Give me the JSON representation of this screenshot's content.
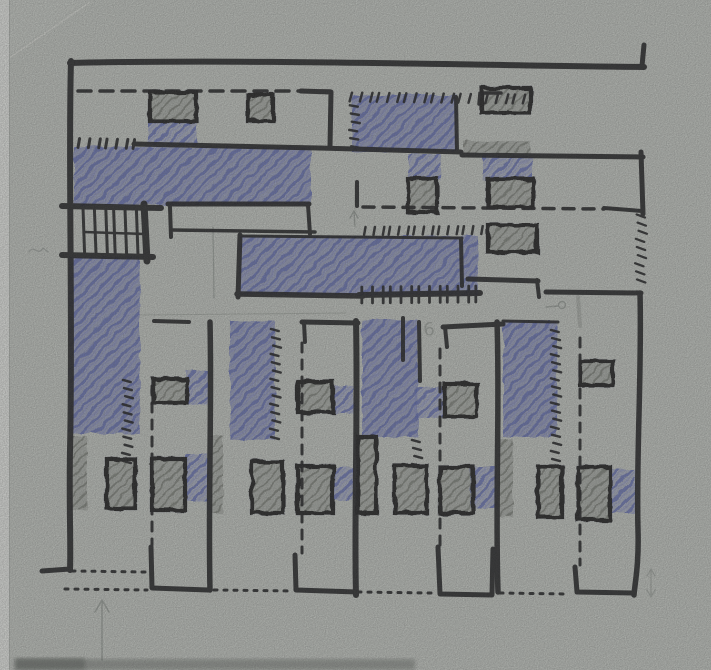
{
  "meta": {
    "title": "Hand-drawn architectural plan sketch",
    "media": "black marker, blue crayon and gray pencil on gray sketch paper"
  },
  "canvas": {
    "width": 711,
    "height": 670
  },
  "colors": {
    "paper": "#c6cac4",
    "paper_light": "#ced2cc",
    "crease": "#daddd7",
    "edge_strip": "#e9ebe7",
    "edge_line": "#aaaea9",
    "shadow": "#5c605b",
    "ink": "#1c1c1e",
    "blue": "#5e69b3",
    "blue_light": "#8b93c9",
    "blue_bg": "rgba(104,113,184,0.30)",
    "blue_dense": "rgba(92,102,175,0.22)",
    "gray": "#70746c",
    "gray_bg": "rgba(128,132,125,0.38)",
    "pencil": "#878d88"
  },
  "drawing": {
    "blue_areas": [
      {
        "x": 148,
        "y": 122,
        "w": 49,
        "h": 23,
        "dense": false
      },
      {
        "x": 74,
        "y": 147,
        "w": 237,
        "h": 58,
        "dense": true
      },
      {
        "x": 69,
        "y": 257,
        "w": 71,
        "h": 177,
        "dense": true
      },
      {
        "x": 352,
        "y": 95,
        "w": 105,
        "h": 57,
        "dense": true
      },
      {
        "x": 408,
        "y": 154,
        "w": 33,
        "h": 27,
        "dense": false
      },
      {
        "x": 483,
        "y": 155,
        "w": 49,
        "h": 26,
        "dense": false
      },
      {
        "x": 240,
        "y": 236,
        "w": 238,
        "h": 59,
        "dense": true
      },
      {
        "x": 230,
        "y": 321,
        "w": 45,
        "h": 119,
        "dense": true
      },
      {
        "x": 362,
        "y": 320,
        "w": 56,
        "h": 117,
        "dense": true
      },
      {
        "x": 503,
        "y": 321,
        "w": 54,
        "h": 116,
        "dense": true
      },
      {
        "x": 415,
        "y": 387,
        "w": 32,
        "h": 31,
        "dense": false
      },
      {
        "x": 186,
        "y": 371,
        "w": 22,
        "h": 34,
        "dense": false
      },
      {
        "x": 333,
        "y": 386,
        "w": 21,
        "h": 28,
        "dense": false
      },
      {
        "x": 185,
        "y": 454,
        "w": 23,
        "h": 47,
        "dense": false
      },
      {
        "x": 333,
        "y": 467,
        "w": 20,
        "h": 33,
        "dense": false
      },
      {
        "x": 470,
        "y": 467,
        "w": 27,
        "h": 41,
        "dense": false
      },
      {
        "x": 610,
        "y": 469,
        "w": 25,
        "h": 44,
        "dense": false
      }
    ],
    "gray_areas": [
      {
        "x": 150,
        "y": 92,
        "w": 46,
        "h": 29,
        "outlined": true
      },
      {
        "x": 248,
        "y": 95,
        "w": 25,
        "h": 26,
        "outlined": true
      },
      {
        "x": 482,
        "y": 88,
        "w": 48,
        "h": 25,
        "outlined": true
      },
      {
        "x": 463,
        "y": 141,
        "w": 67,
        "h": 12,
        "outlined": false
      },
      {
        "x": 488,
        "y": 179,
        "w": 45,
        "h": 28,
        "outlined": true
      },
      {
        "x": 488,
        "y": 225,
        "w": 49,
        "h": 27,
        "outlined": true
      },
      {
        "x": 408,
        "y": 179,
        "w": 29,
        "h": 33,
        "outlined": true
      },
      {
        "x": 580,
        "y": 361,
        "w": 33,
        "h": 24,
        "outlined": true
      },
      {
        "x": 153,
        "y": 379,
        "w": 34,
        "h": 24,
        "outlined": true
      },
      {
        "x": 298,
        "y": 382,
        "w": 35,
        "h": 30,
        "outlined": true
      },
      {
        "x": 445,
        "y": 384,
        "w": 32,
        "h": 33,
        "outlined": true
      },
      {
        "x": 70,
        "y": 436,
        "w": 17,
        "h": 74,
        "outlined": false
      },
      {
        "x": 211,
        "y": 436,
        "w": 12,
        "h": 77,
        "outlined": false
      },
      {
        "x": 107,
        "y": 459,
        "w": 28,
        "h": 49,
        "outlined": true
      },
      {
        "x": 152,
        "y": 459,
        "w": 33,
        "h": 51,
        "outlined": true
      },
      {
        "x": 252,
        "y": 462,
        "w": 31,
        "h": 51,
        "outlined": true
      },
      {
        "x": 298,
        "y": 466,
        "w": 35,
        "h": 47,
        "outlined": true
      },
      {
        "x": 395,
        "y": 466,
        "w": 32,
        "h": 47,
        "outlined": true
      },
      {
        "x": 440,
        "y": 467,
        "w": 33,
        "h": 46,
        "outlined": true
      },
      {
        "x": 358,
        "y": 437,
        "w": 18,
        "h": 76,
        "outlined": true
      },
      {
        "x": 499,
        "y": 439,
        "w": 14,
        "h": 78,
        "outlined": false
      },
      {
        "x": 538,
        "y": 467,
        "w": 24,
        "h": 50,
        "outlined": true
      },
      {
        "x": 578,
        "y": 467,
        "w": 32,
        "h": 53,
        "outlined": true
      }
    ],
    "ink_lines": [
      {
        "d": "M70,63 C240,59 460,65 644,67",
        "w": 6
      },
      {
        "d": "M642,66 L644,45",
        "w": 5
      },
      {
        "d": "M71,61 C68,160 73,320 70,450 C69,510 71,545 70,570",
        "w": 6
      },
      {
        "d": "M70,569 L42,571",
        "w": 5
      },
      {
        "d": "M301,91 L331,92 L330,147",
        "w": 5
      },
      {
        "d": "M456,97 L457,151",
        "w": 4
      },
      {
        "d": "M479,104 L480,93 L501,93",
        "w": 3.5
      },
      {
        "d": "M134,144 L319,148 L461,152",
        "w": 5
      },
      {
        "d": "M62,206 L161,208",
        "w": 6
      },
      {
        "d": "M62,255 L153,257",
        "w": 6
      },
      {
        "d": "M144,204 L147,261",
        "w": 7
      },
      {
        "d": "M84,232 L145,234",
        "w": 2.5
      },
      {
        "d": "M168,204 L309,204",
        "w": 5
      },
      {
        "d": "M308,205 L310,234",
        "w": 4
      },
      {
        "d": "M172,230 L315,232",
        "w": 3.5
      },
      {
        "d": "M170,207 L171,237",
        "w": 4
      },
      {
        "d": "M240,235 L238,297",
        "w": 5
      },
      {
        "d": "M237,294 L363,296",
        "w": 5.5
      },
      {
        "d": "M240,236 L462,238",
        "w": 3
      },
      {
        "d": "M461,239 L462,286",
        "w": 4
      },
      {
        "d": "M359,295 L480,293",
        "w": 6
      },
      {
        "d": "M462,155 L643,157",
        "w": 5
      },
      {
        "d": "M641,152 L643,214",
        "w": 5
      },
      {
        "d": "M468,279 L538,281",
        "w": 5
      },
      {
        "d": "M537,280 L539,297",
        "w": 4
      },
      {
        "d": "M546,292 L641,293",
        "w": 5
      },
      {
        "d": "M640,293 C642,370 636,460 638,530 C639,565 635,582 634,595",
        "w": 5.5
      },
      {
        "d": "M154,321 L189,322",
        "w": 4
      },
      {
        "d": "M302,322 L358,323",
        "w": 5
      },
      {
        "d": "M304,323 L305,342",
        "w": 4
      },
      {
        "d": "M443,327 L503,324",
        "w": 5
      },
      {
        "d": "M445,327 L447,347",
        "w": 4
      },
      {
        "d": "M210,322 C212,410 208,500 210,590",
        "w": 5.5
      },
      {
        "d": "M356,321 C358,420 354,520 356,595",
        "w": 6
      },
      {
        "d": "M497,322 C500,410 495,500 498,592",
        "w": 5.5
      },
      {
        "d": "M151,547 L152,588 L208,590",
        "w": 5
      },
      {
        "d": "M295,555 L296,590 L357,592",
        "w": 5
      },
      {
        "d": "M438,547 L440,594 L492,595 L493,549",
        "w": 5
      },
      {
        "d": "M575,567 L577,592 L633,593",
        "w": 5
      },
      {
        "d": "M419,322 L420,381",
        "w": 4
      },
      {
        "d": "M403,318 L403,360",
        "w": 4
      },
      {
        "d": "M357,182 L357,206",
        "w": 4
      },
      {
        "d": "M604,208 L642,211",
        "w": 4
      },
      {
        "d": "M503,321 L558,322",
        "w": 3
      }
    ],
    "dashed_lines": [
      {
        "d": "M78,91 L330,91",
        "w": 3.5,
        "dash": "13 9"
      },
      {
        "d": "M363,207 L604,209",
        "w": 3.5,
        "dash": "11 9"
      },
      {
        "d": "M152,386 L152,545",
        "w": 3,
        "dash": "9 8"
      },
      {
        "d": "M302,343 L302,553",
        "w": 3,
        "dash": "9 8"
      },
      {
        "d": "M440,349 L440,545",
        "w": 3,
        "dash": "9 8"
      },
      {
        "d": "M580,338 L580,565",
        "w": 3,
        "dash": "9 8"
      }
    ],
    "dotted_lines": [
      {
        "d": "M72,571 L146,572",
        "w": 3,
        "dash": "3 7"
      },
      {
        "d": "M65,589 L147,590",
        "w": 3,
        "dash": "3 7"
      },
      {
        "d": "M214,590 L293,591",
        "w": 3,
        "dash": "3 7"
      },
      {
        "d": "M358,592 L431,593",
        "w": 3,
        "dash": "3 7"
      },
      {
        "d": "M500,593 L567,594",
        "w": 3,
        "dash": "3 7"
      }
    ],
    "tick_groups": [
      {
        "x1": 352,
        "y1": 97,
        "x2": 524,
        "y2": 99,
        "spacing": 9,
        "len": 9,
        "angle": 105,
        "w": 2.5
      },
      {
        "x1": 355,
        "y1": 106,
        "x2": 354,
        "y2": 147,
        "spacing": 8,
        "len": 8,
        "angle": 10,
        "w": 2.5
      },
      {
        "x1": 80,
        "y1": 143,
        "x2": 135,
        "y2": 144,
        "spacing": 9,
        "len": 9,
        "angle": 100,
        "w": 3
      },
      {
        "x1": 366,
        "y1": 231,
        "x2": 489,
        "y2": 230,
        "spacing": 8,
        "len": 8,
        "angle": 100,
        "w": 2.5
      },
      {
        "x1": 363,
        "y1": 295,
        "x2": 477,
        "y2": 294,
        "spacing": 9.5,
        "len": 16,
        "angle": 90,
        "w": 2.8
      },
      {
        "x1": 642,
        "y1": 216,
        "x2": 640,
        "y2": 281,
        "spacing": 8,
        "len": 9,
        "angle": 20,
        "w": 2.2
      },
      {
        "x1": 128,
        "y1": 381,
        "x2": 127,
        "y2": 462,
        "spacing": 8,
        "len": 8,
        "angle": 15,
        "w": 2.5
      },
      {
        "x1": 276,
        "y1": 330,
        "x2": 275,
        "y2": 438,
        "spacing": 8,
        "len": 8,
        "angle": 15,
        "w": 2.5
      },
      {
        "x1": 417,
        "y1": 441,
        "x2": 417,
        "y2": 465,
        "spacing": 7,
        "len": 8,
        "angle": 15,
        "w": 2.5
      },
      {
        "x1": 556,
        "y1": 331,
        "x2": 556,
        "y2": 460,
        "spacing": 8,
        "len": 8,
        "angle": 15,
        "w": 2.5
      },
      {
        "x1": 85,
        "y1": 231,
        "x2": 136,
        "y2": 232,
        "spacing": 10,
        "len": 46,
        "angle": 88,
        "w": 3
      }
    ],
    "pencil_lines": [
      {
        "d": "M213,227 L214,298",
        "w": 1.3,
        "o": 0.6
      },
      {
        "d": "M140,315 L346,313",
        "w": 1.1,
        "o": 0.45
      },
      {
        "d": "M355,184 L355,211",
        "w": 1.2,
        "o": 0.4
      },
      {
        "d": "M578,297 L580,326",
        "w": 4,
        "o": 0.4
      },
      {
        "d": "M29,252 C34,244 38,257 43,248 L48,252",
        "w": 1.3,
        "o": 0.55
      }
    ],
    "pencil_arrows": [
      {
        "shaft": "M102,660 L102,601",
        "head": "M95,612 L102,600 L109,612",
        "w": 1.5,
        "o": 0.65
      },
      {
        "shaft": "M355,226 L354,212",
        "head": "M350,218 L354,211 L358,218",
        "w": 1.4,
        "o": 0.7
      },
      {
        "shaft": "M651,570 L651,596",
        "head": "M647,576 L651,569 L655,576",
        "head2": "M647,590 L651,597 L655,590",
        "w": 1.2,
        "o": 0.55
      }
    ],
    "pencil_circles": [
      {
        "cx": 562,
        "cy": 305,
        "r": 3.5,
        "line": "M558,306 L546,307",
        "w": 1.4,
        "o": 0.65
      }
    ],
    "pencil_texts": [
      {
        "x": 424,
        "y": 336,
        "t": "6",
        "size": 18,
        "o": 0.6
      }
    ],
    "paper": {
      "edge_strip": {
        "x": 0,
        "y": 0,
        "w": 9,
        "h": 670
      },
      "crease_line": "M2,63 L90,2",
      "crease_triangle": "M0,0 L88,0 L0,62 Z",
      "shadow": {
        "x": 15,
        "y": 659,
        "w": 400,
        "h": 11
      },
      "shadow_blob": {
        "x": 15,
        "y": 658,
        "w": 70,
        "h": 12
      }
    }
  }
}
